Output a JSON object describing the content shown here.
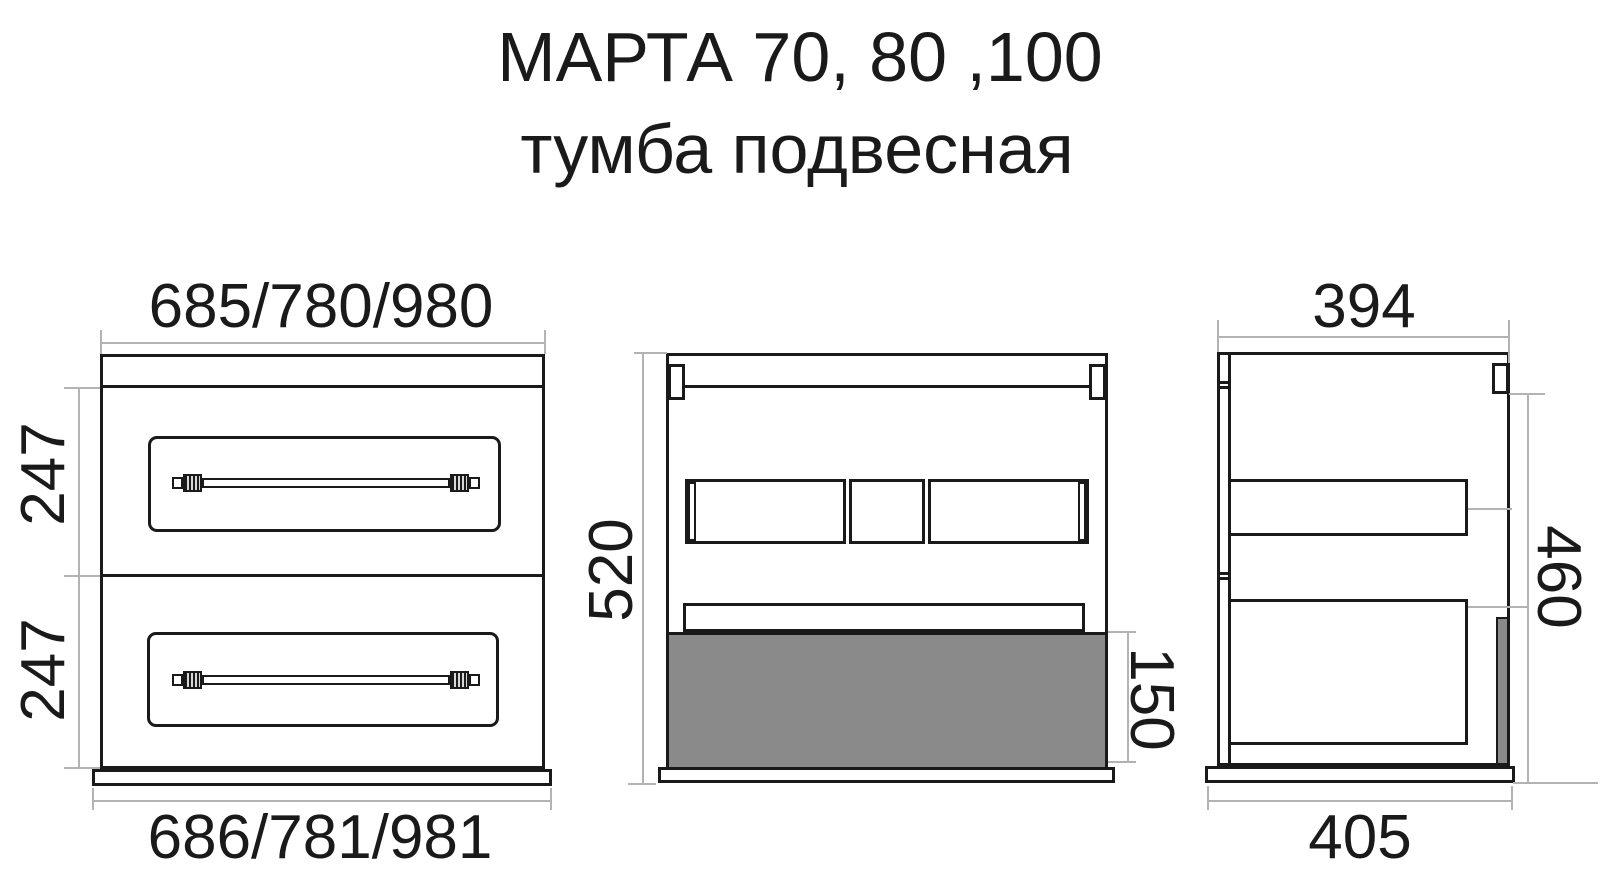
{
  "title": {
    "line1": "МАРТА 70, 80 ,100",
    "line2": "тумба подвесная"
  },
  "front_view": {
    "dim_width_top": "685/780/980",
    "dim_drawer1_height": "247",
    "dim_drawer2_height": "247",
    "dim_width_bottom": "686/781/981"
  },
  "section_view": {
    "dim_height": "520",
    "dim_bottom_panel": "150"
  },
  "side_view": {
    "dim_depth_top": "394",
    "dim_height": "460",
    "dim_depth_bottom": "405"
  },
  "colors": {
    "line": "#1a1a1a",
    "dim_line": "#b3b3b3",
    "gray_fill": "#8a8a8a",
    "background": "#ffffff"
  }
}
